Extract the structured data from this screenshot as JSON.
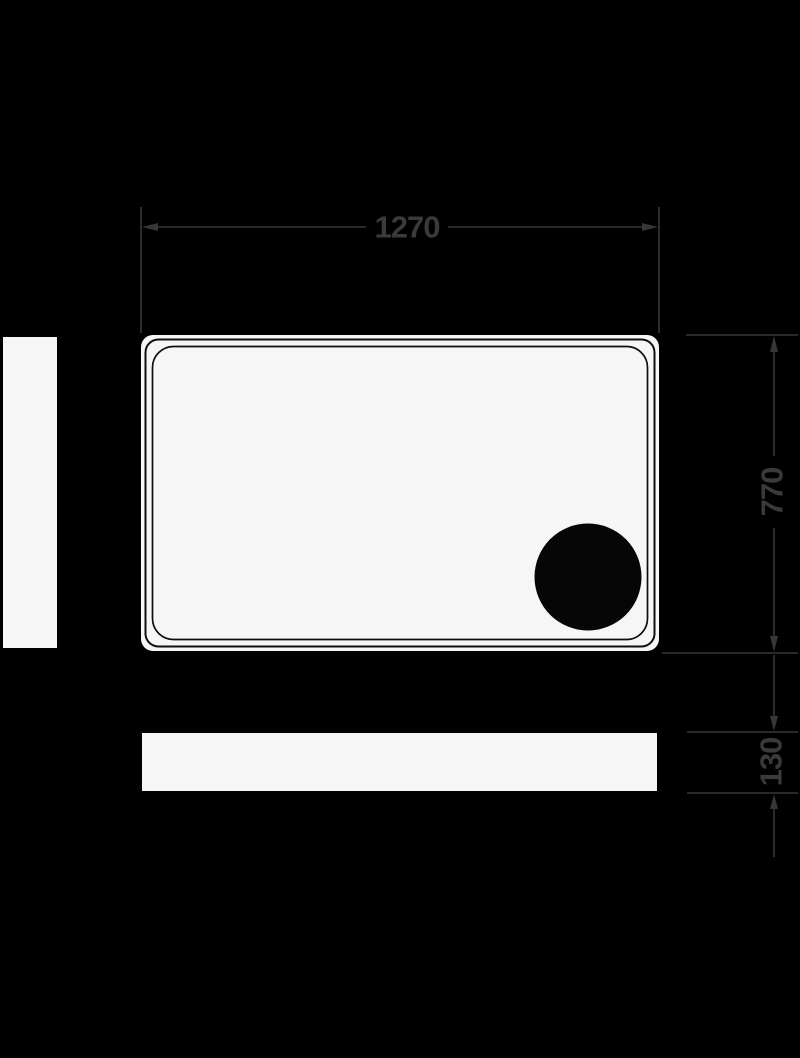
{
  "figure": {
    "kind": "technical-dimension-drawing",
    "subject": "rectangular shower tray: plan view with corner drain, left side panel and front apron elevation",
    "dimension_labels": {
      "width": "1270",
      "depth": "770",
      "height": "130"
    },
    "colors": {
      "background": "#000000",
      "surface_fill": "#f6f6f6",
      "tray_outline": "#0e0e0e",
      "drain_fill": "#060606",
      "dimension_line": "#373737",
      "dimension_text": "#3a3a3a"
    }
  }
}
